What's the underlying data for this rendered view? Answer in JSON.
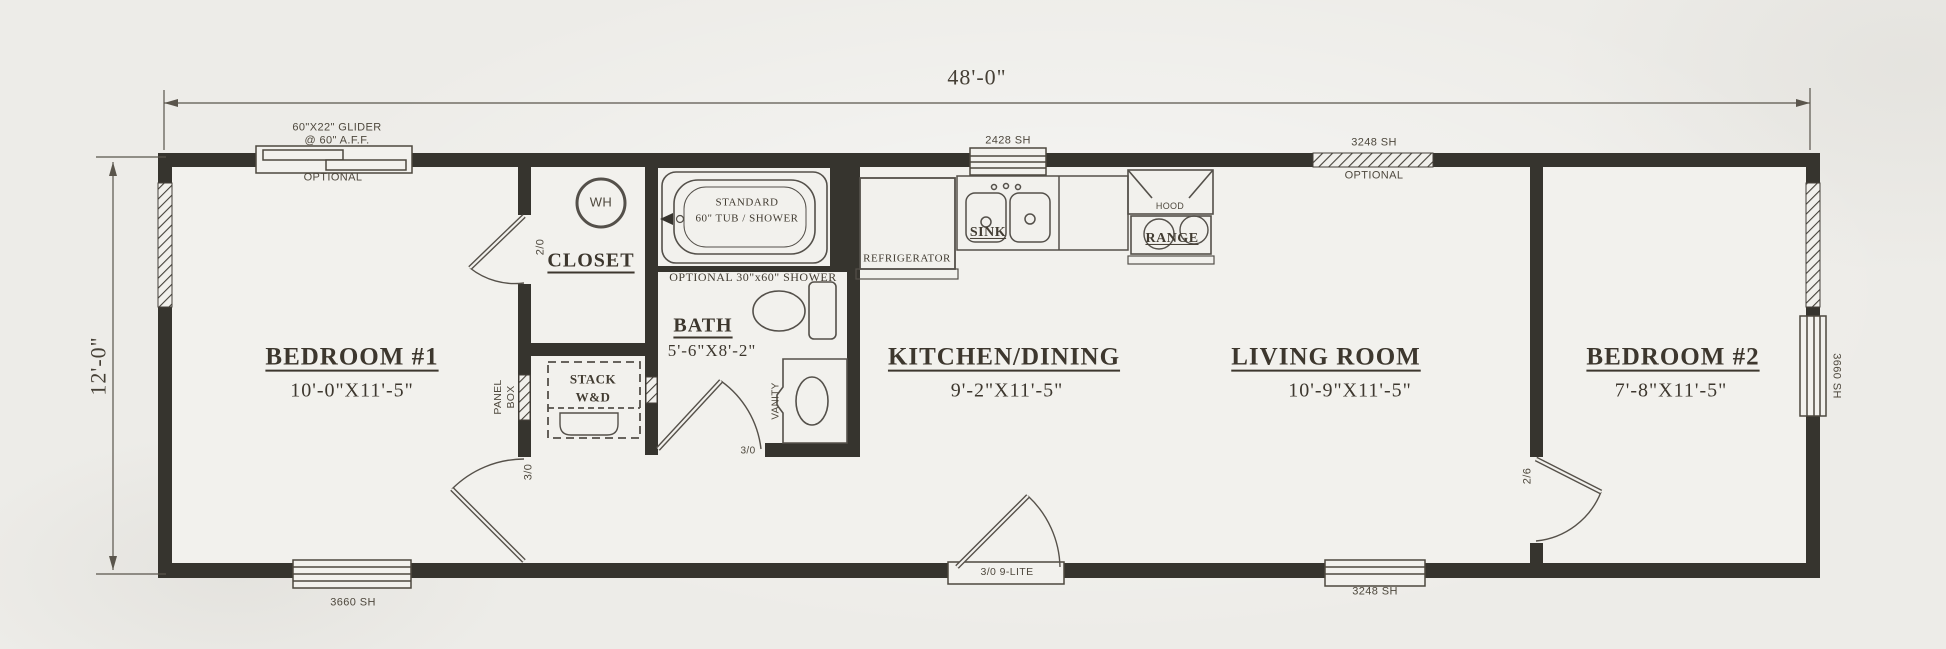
{
  "overall": {
    "width_label": "48'-0\"",
    "height_label": "12'-0\""
  },
  "rooms": {
    "bedroom1": {
      "name": "BEDROOM #1",
      "size": "10'-0\"X11'-5\""
    },
    "closet": {
      "name": "CLOSET"
    },
    "bath": {
      "name": "BATH",
      "size": "5'-6\"X8'-2\""
    },
    "kitchen": {
      "name": "KITCHEN/DINING",
      "size": "9'-2\"X11'-5\""
    },
    "living": {
      "name": "LIVING ROOM",
      "size": "10'-9\"X11'-5\""
    },
    "bedroom2": {
      "name": "BEDROOM #2",
      "size": "7'-8\"X11'-5\""
    }
  },
  "windows": {
    "glider_line1": "60\"X22\" GLIDER",
    "glider_line2": "@ 60\" A.F.F.",
    "glider_note": "OPTIONAL",
    "top_kitchen": "2428 SH",
    "top_living": "3248 SH",
    "top_living_note": "OPTIONAL",
    "bottom_bedroom1": "3660 SH",
    "bottom_living": "3248 SH",
    "right_bedroom2": "3660 SH"
  },
  "doors": {
    "bedroom1_closet": "2/0",
    "bedroom1_entry": "3/0",
    "bath": "3/0",
    "entry": "3/0 9-LITE",
    "bedroom2": "2/6"
  },
  "fixtures": {
    "water_heater": "WH",
    "tub_line1": "STANDARD",
    "tub_line2": "60\" TUB / SHOWER",
    "shower_note": "OPTIONAL 30\"x60\" SHOWER",
    "vanity": "VANITY",
    "panel_box_line1": "PANEL",
    "panel_box_line2": "BOX",
    "laundry_line1": "STACK",
    "laundry_line2": "W&D"
  },
  "appliances": {
    "refrigerator": "REFRIGERATOR",
    "sink": "SINK",
    "hood": "HOOD",
    "range": "RANGE"
  },
  "colors": {
    "wall": "#36342e",
    "line": "#545047",
    "paper": "#f1f0ec"
  }
}
